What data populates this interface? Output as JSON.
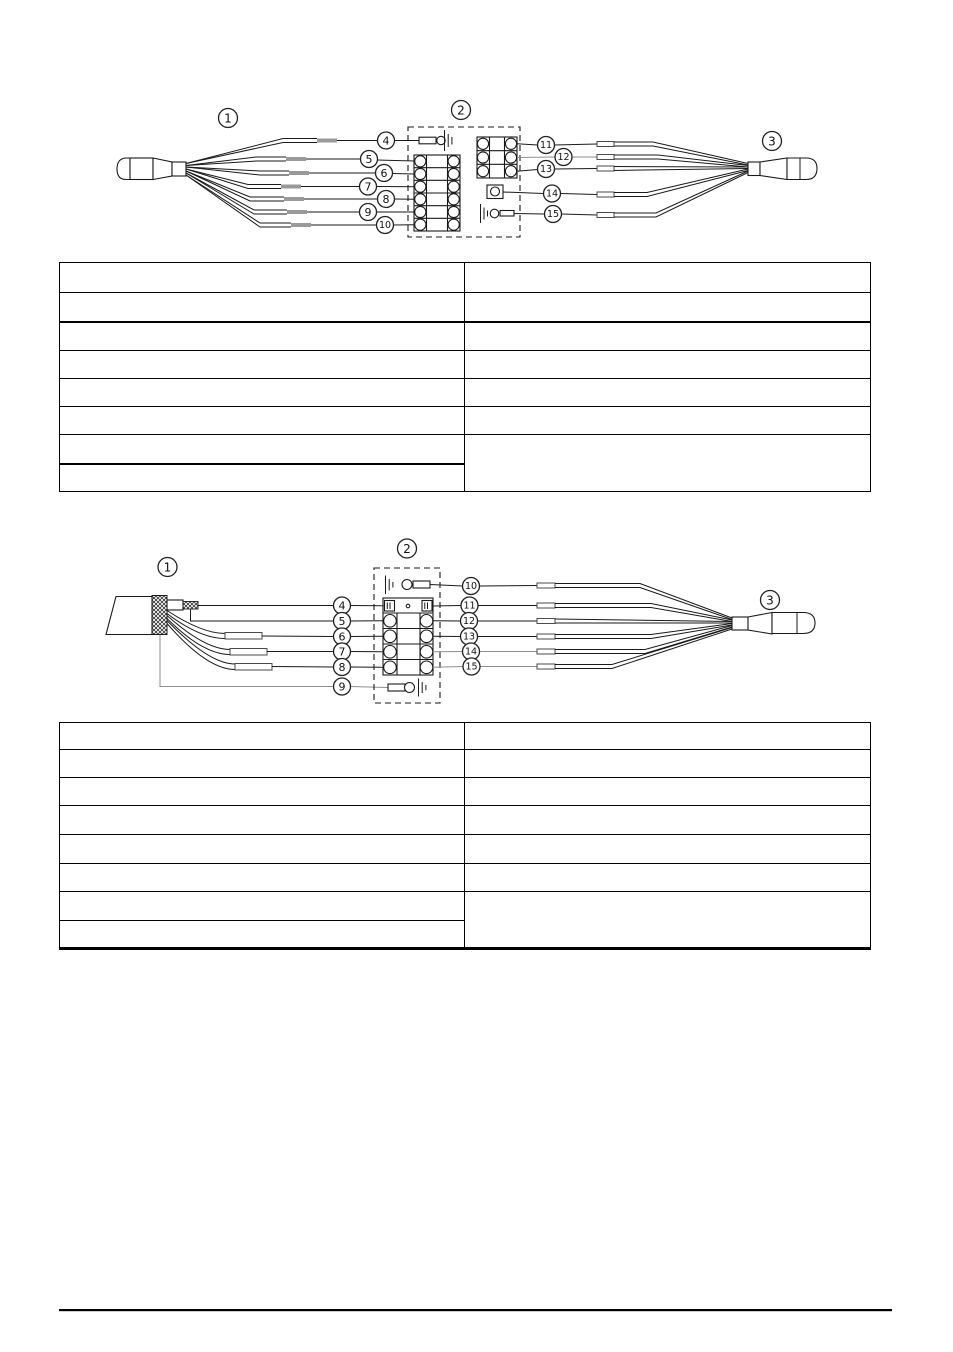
{
  "colors": {
    "background": "#ffffff",
    "line": "#1a1a1a",
    "wire_gray": "#8f8f8f"
  },
  "diagram1": {
    "ref_labels": {
      "left_connector": "1",
      "junction_box": "2",
      "right_connector": "3"
    },
    "left_pin_labels": [
      "4",
      "5",
      "6",
      "7",
      "8",
      "9",
      "10"
    ],
    "right_pin_labels": [
      "11",
      "12",
      "13",
      "14",
      "15"
    ]
  },
  "diagram2": {
    "ref_labels": {
      "cable": "1",
      "junction_box": "2",
      "right_connector": "3"
    },
    "left_pin_labels": [
      "4",
      "5",
      "6",
      "7",
      "8",
      "9"
    ],
    "right_pin_labels": [
      "10",
      "11",
      "12",
      "13",
      "14",
      "15"
    ]
  },
  "table1": {
    "row_count": 8,
    "column_count": 2
  },
  "table2": {
    "row_count": 8,
    "column_count": 2
  }
}
